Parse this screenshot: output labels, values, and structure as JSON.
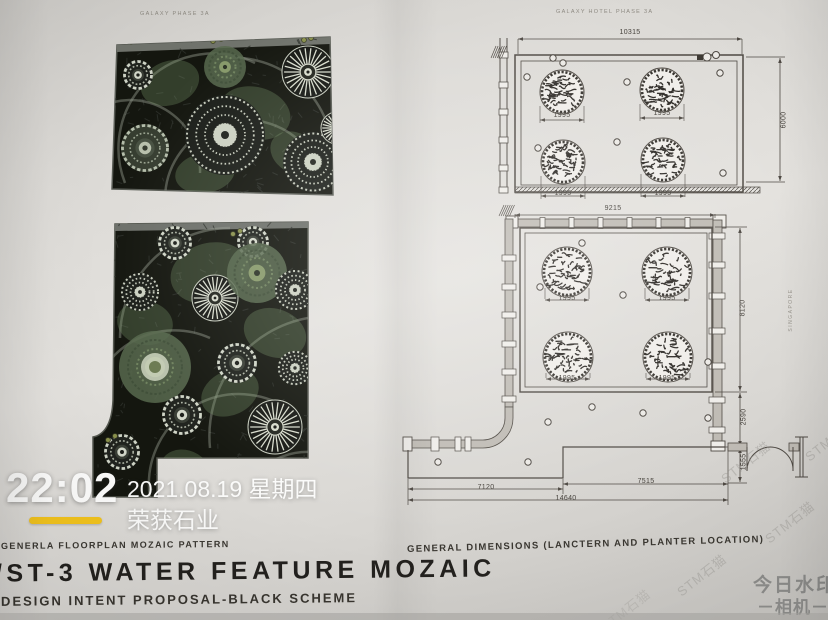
{
  "photo_watermark": {
    "time": "22:02",
    "date": "2021.08.19 星期四",
    "brand": "荣获石业",
    "app_line1": "今日水印",
    "app_line2": "－相机－"
  },
  "titles": {
    "kicker": "GENERLA FLOORPLAN MOZAIC PATTERN",
    "main": "/ST-3 WATER FEATURE MOZAIC",
    "subtitle": "DESIGN INTENT PROPOSAL-BLACK SCHEME",
    "right_caption": "GENERAL DIMENSIONS (LANCTERN AND PLANTER LOCATION)"
  },
  "mosaics": {
    "top_header": "GALAXY PHASE 3A"
  },
  "plans": {
    "top": {
      "header": "GALAXY HOTEL PHASE 3A",
      "width_dim": "10315",
      "height_dim": "6000",
      "planter_dim": "1995"
    },
    "bottom": {
      "width_dim": "9215",
      "height_dim": "8120",
      "offset_dim": "2590",
      "door_dim": "1555",
      "left_dim": "7120",
      "right_dim": "7515",
      "total_dim": "14640",
      "planter_dim": "1995"
    }
  },
  "watermarks": {
    "diagonal": "STM石猫",
    "vertical": "SINGAPORE"
  },
  "colors": {
    "accent_yellow": "#f3c41d",
    "ink": "#4e4943",
    "mosaic_black": "#14160f"
  }
}
